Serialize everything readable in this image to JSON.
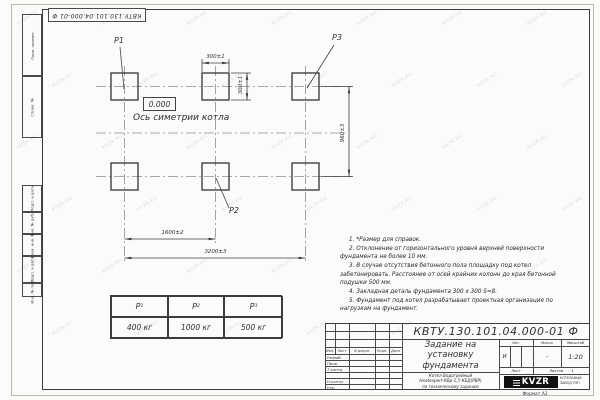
{
  "page": {
    "doc_number_top": "КВТУ.130.101.04.000-01 Ф",
    "format_label": "Формат А3",
    "watermark_text": "KVZR.RU"
  },
  "margin": {
    "top_cells": [
      "Перв. примен.",
      "Справ. №"
    ],
    "bottom_cells": [
      "Подп. и дата",
      "Инв. № дубл.",
      "Взам. инв. №",
      "Подп. и дата",
      "Инв. № подл."
    ]
  },
  "drawing": {
    "labels": {
      "p1": "P1",
      "p2": "P2",
      "p3": "P3"
    },
    "level_mark": "0.000",
    "axis_label": "Ось симетрии котла",
    "dimensions": {
      "top_width": "300±1",
      "side_height": "300±1",
      "row_spacing": "960±3",
      "column_spacing": "1600±2",
      "total_length": "3200±3"
    }
  },
  "notes": [
    "1. *Размер для справок.",
    "2. Отклонение от горизонтального уровня верхней поверхности фундамента не более 10 мм.",
    "3. В случае отсутствия бетонного пола площадку под котел забетонировать. Расстояние от осей крайних колонн до края бетонной подушки 500 мм.",
    "4. Закладная деталь фундамента 300 х 300 S=8.",
    "5. Фундамент под котел разрабатывает проектная организация по нагрузкам на фундамент."
  ],
  "load_table": {
    "headers": [
      {
        "p": "P",
        "sub": "1"
      },
      {
        "p": "P",
        "sub": "2"
      },
      {
        "p": "P",
        "sub": "3"
      }
    ],
    "values": [
      "400 кг",
      "1000 кг",
      "500 кг"
    ]
  },
  "title_block": {
    "doc_number": "КВТУ.130.101.04.000-01 Ф",
    "title_lines": [
      "Задание на",
      "установку",
      "фундамента"
    ],
    "product_lines": [
      "Котел Водогрейный",
      "Heatexpert-КВр-1,5-КБД(РВР)",
      "по техническому заданию"
    ],
    "header_cols": [
      "Изм.",
      "Лист",
      "N докум.",
      "Подп.",
      "Дата"
    ],
    "row_labels": [
      "Разраб.",
      "Пров.",
      "Т.контр.",
      "Н.контр.",
      "Утв."
    ],
    "lit_label": "Лит.",
    "mass_label": "Масса",
    "scale_label": "Масштаб",
    "lit_value": "И",
    "mass_value": "-",
    "scale_value": "1:20",
    "sheet_label": "Лист",
    "sheets_label": "Листов",
    "sheets_value": "1",
    "logo_text": "KVZR",
    "company_lines": [
      "КОТЕЛЬНЫЙ",
      "ЗАВОД РЭП"
    ]
  }
}
